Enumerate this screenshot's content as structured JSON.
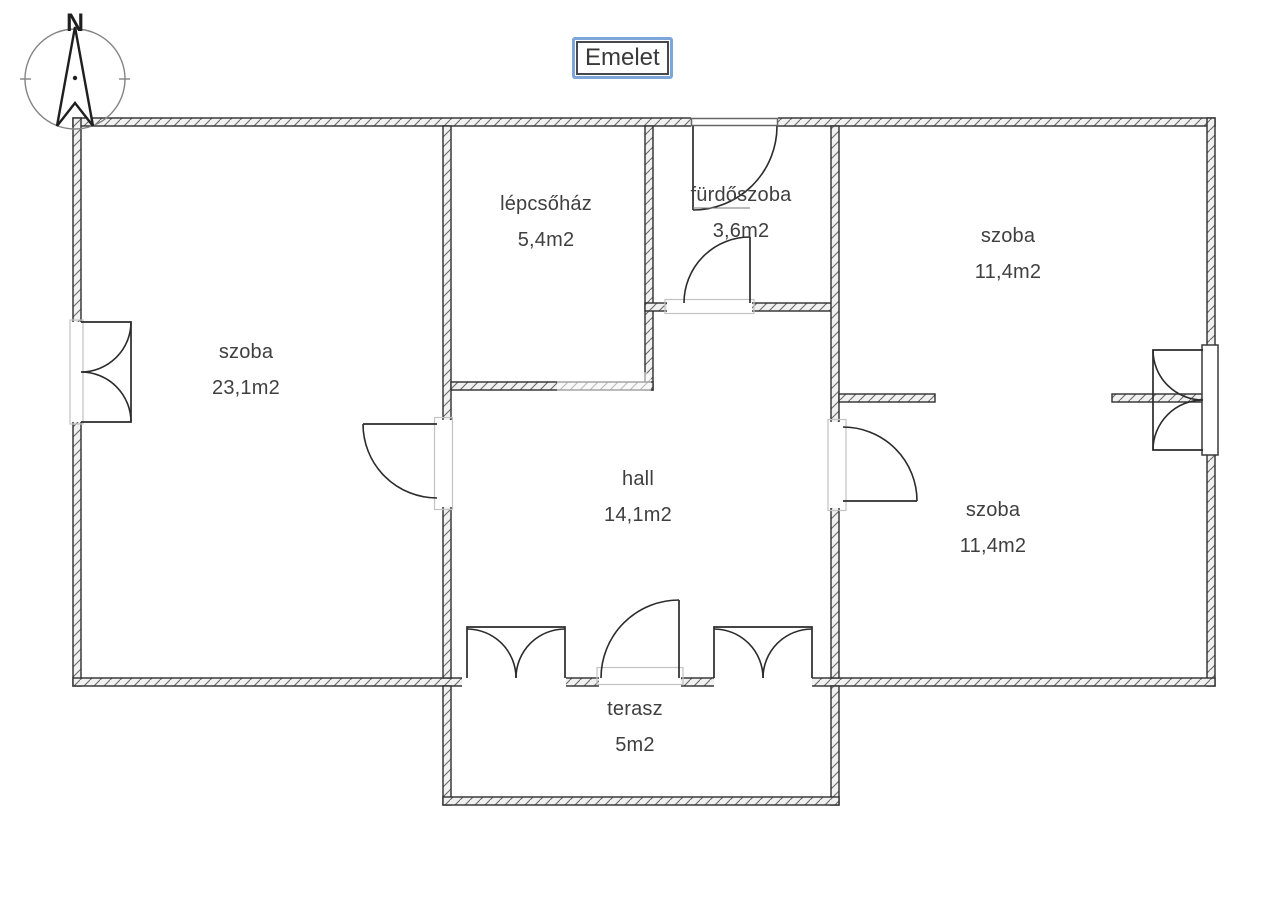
{
  "title": "Emelet",
  "compass": {
    "north_label": "N"
  },
  "rooms": [
    {
      "id": "szoba-left",
      "name": "szoba",
      "area": "23,1m2"
    },
    {
      "id": "lepcsohaz",
      "name": "lépcsőház",
      "area": "5,4m2"
    },
    {
      "id": "furdoszoba",
      "name": "fürdőszoba",
      "area": "3,6m2"
    },
    {
      "id": "szoba-top-right",
      "name": "szoba",
      "area": "11,4m2"
    },
    {
      "id": "hall",
      "name": "hall",
      "area": "14,1m2"
    },
    {
      "id": "szoba-bottom-right",
      "name": "szoba",
      "area": "11,4m2"
    },
    {
      "id": "terasz",
      "name": "terasz",
      "area": "5m2"
    }
  ],
  "colors": {
    "wall_line": "#2e2e2e",
    "wall_fill": "#f1f1f1",
    "hatch": "#6a6a6a",
    "symbol_line": "#2b2b2b",
    "frame_light": "#c2c2c2",
    "label_text": "#3f3f3f",
    "title_border_outer": "#7ca6d9",
    "title_border_inner": "#47474f"
  }
}
